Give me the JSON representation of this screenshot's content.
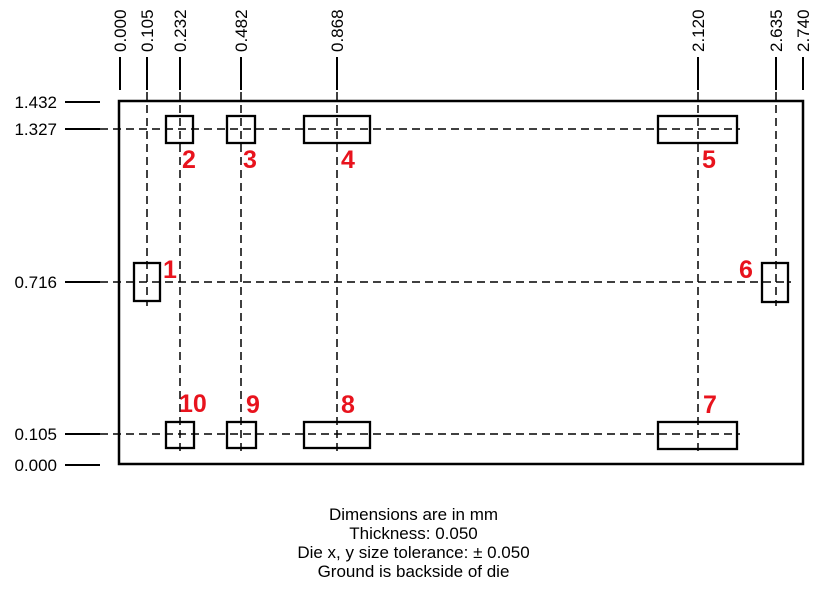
{
  "diagram": {
    "x_axis_labels": [
      {
        "text": "0.000",
        "x": 120
      },
      {
        "text": "0.105",
        "x": 147
      },
      {
        "text": "0.232",
        "x": 180
      },
      {
        "text": "0.482",
        "x": 241
      },
      {
        "text": "0.868",
        "x": 337
      },
      {
        "text": "2.120",
        "x": 698
      },
      {
        "text": "2.635",
        "x": 776
      },
      {
        "text": "2.740",
        "x": 803
      }
    ],
    "y_axis_labels": [
      {
        "text": "1.432",
        "y": 102
      },
      {
        "text": "1.327",
        "y": 129
      },
      {
        "text": "0.716",
        "y": 282
      },
      {
        "text": "0.105",
        "y": 434
      },
      {
        "text": "0.000",
        "y": 465
      }
    ],
    "die": {
      "x": 119,
      "y": 101,
      "w": 684,
      "h": 363
    },
    "pads": [
      {
        "num": "1",
        "x": 134,
        "y": 263,
        "w": 26,
        "h": 38,
        "nx": 163,
        "ny": 278
      },
      {
        "num": "2",
        "x": 166,
        "y": 116,
        "w": 27,
        "h": 27,
        "nx": 182,
        "ny": 168
      },
      {
        "num": "3",
        "x": 227,
        "y": 116,
        "w": 28,
        "h": 27,
        "nx": 243,
        "ny": 168
      },
      {
        "num": "4",
        "x": 304,
        "y": 116,
        "w": 66,
        "h": 27,
        "nx": 341,
        "ny": 168
      },
      {
        "num": "5",
        "x": 658,
        "y": 116,
        "w": 79,
        "h": 27,
        "nx": 702,
        "ny": 168
      },
      {
        "num": "6",
        "x": 762,
        "y": 263,
        "w": 26,
        "h": 39,
        "nx": 739,
        "ny": 278
      },
      {
        "num": "7",
        "x": 658,
        "y": 422,
        "w": 79,
        "h": 27,
        "nx": 703,
        "ny": 413
      },
      {
        "num": "8",
        "x": 304,
        "y": 422,
        "w": 66,
        "h": 26,
        "nx": 341,
        "ny": 413
      },
      {
        "num": "9",
        "x": 227,
        "y": 422,
        "w": 29,
        "h": 26,
        "nx": 246,
        "ny": 413
      },
      {
        "num": "10",
        "x": 166,
        "y": 422,
        "w": 28,
        "h": 26,
        "nx": 179,
        "ny": 412
      }
    ],
    "guides": {
      "vertical": [
        {
          "x": 147,
          "y1": 92,
          "y2": 306
        },
        {
          "x": 180,
          "y1": 92,
          "y2": 453
        },
        {
          "x": 241,
          "y1": 92,
          "y2": 453
        },
        {
          "x": 337,
          "y1": 92,
          "y2": 453
        },
        {
          "x": 698,
          "y1": 92,
          "y2": 453
        },
        {
          "x": 776,
          "y1": 92,
          "y2": 306
        }
      ],
      "horizontal": [
        {
          "y": 129,
          "x1": 100,
          "x2": 740
        },
        {
          "y": 282,
          "x1": 100,
          "x2": 791
        },
        {
          "y": 434,
          "x1": 100,
          "x2": 740
        }
      ]
    },
    "ticks": {
      "top_y1": 57,
      "top_y2": 90,
      "left_x1": 65,
      "left_x2": 100
    }
  },
  "notes": {
    "lines": [
      "Dimensions are in mm",
      "Thickness: 0.050",
      "Die x, y size tolerance: ± 0.050",
      "Ground is backside of die"
    ]
  },
  "colors": {
    "line": "#000000",
    "pad_number_red": "#e8131d",
    "text": "#000000"
  }
}
